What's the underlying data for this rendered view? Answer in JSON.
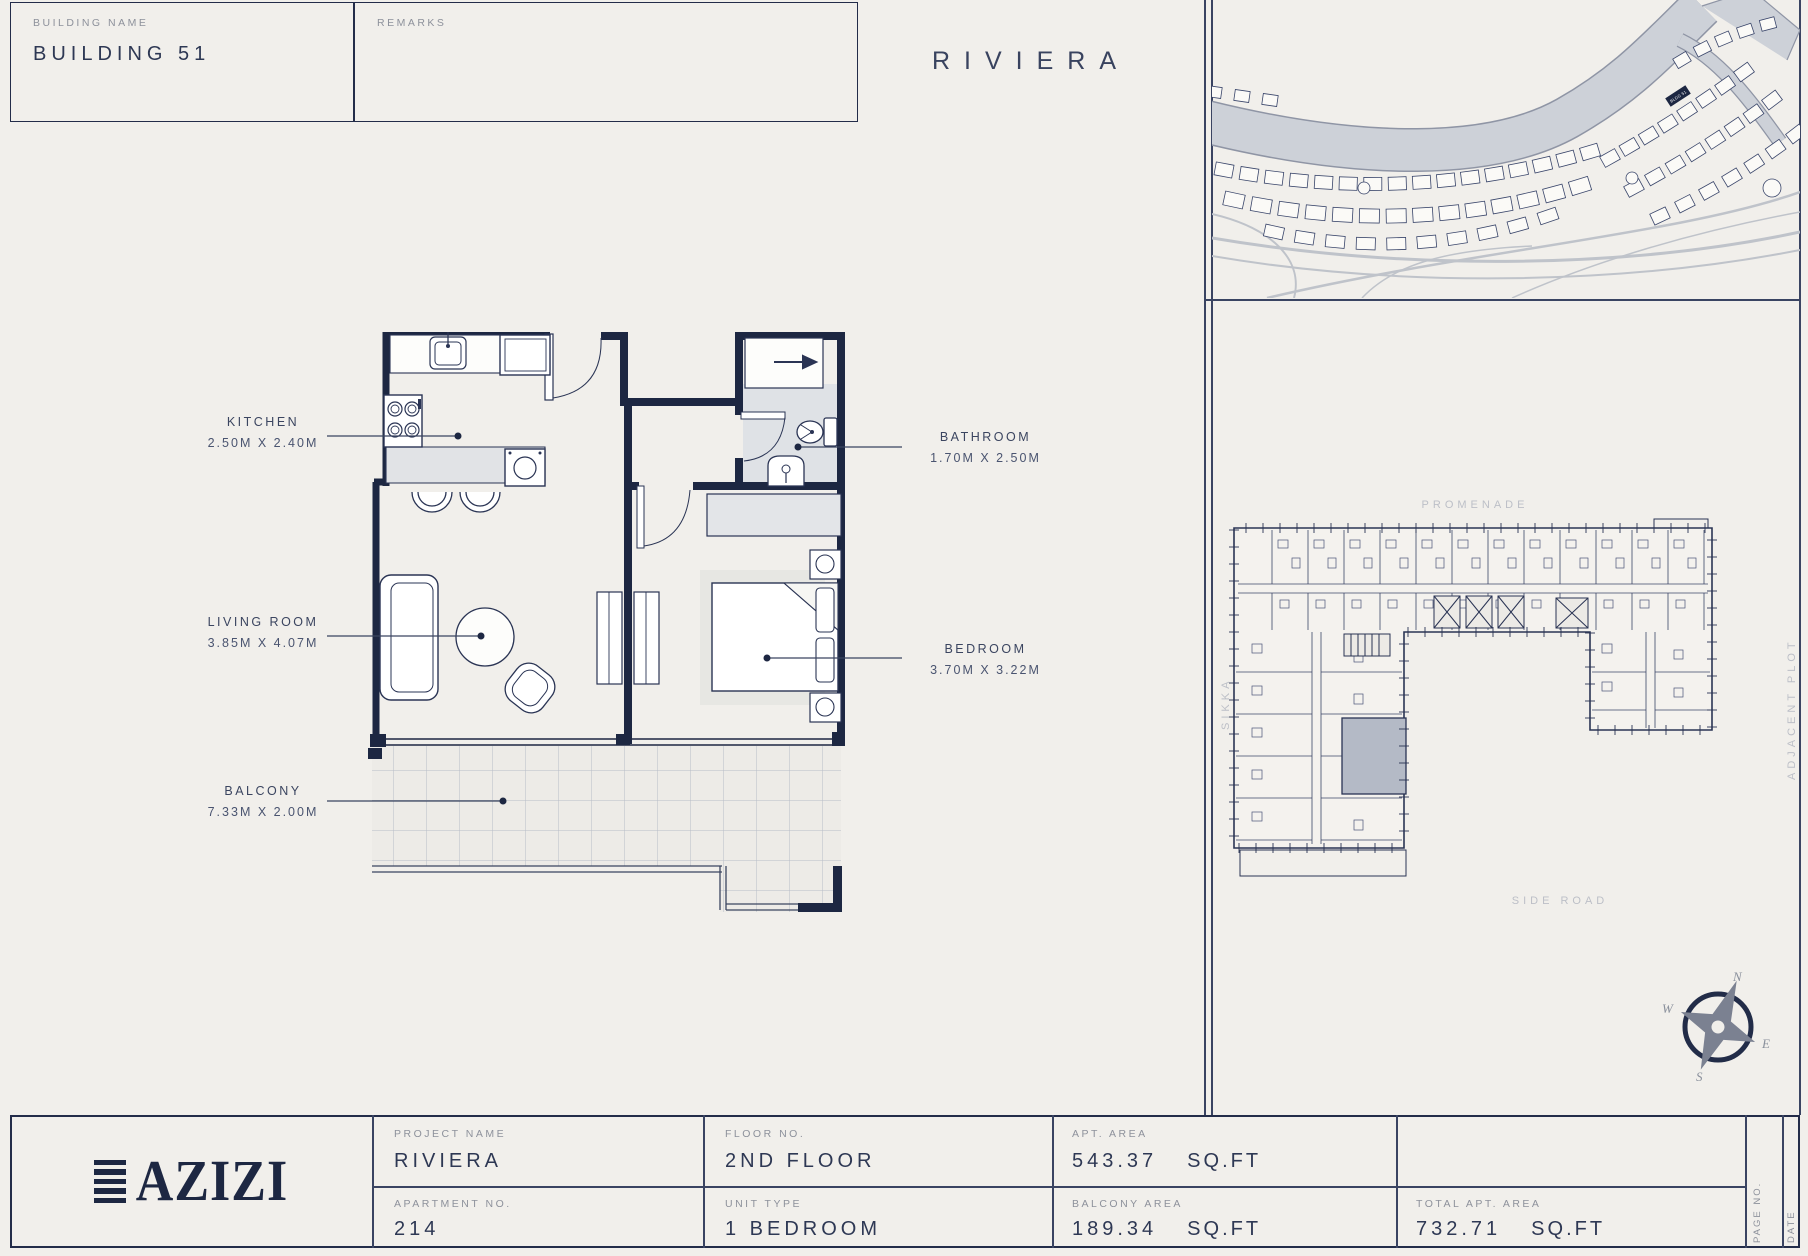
{
  "header": {
    "building_name_label": "BUILDING NAME",
    "building_name": "BUILDING 51",
    "remarks_label": "REMARKS",
    "project_title": "RIVIERA"
  },
  "floor_plan": {
    "rooms": [
      {
        "name": "KITCHEN",
        "dims": "2.50M X 2.40M"
      },
      {
        "name": "LIVING ROOM",
        "dims": "3.85M X 4.07M"
      },
      {
        "name": "BALCONY",
        "dims": "7.33M X 2.00M"
      },
      {
        "name": "BATHROOM",
        "dims": "1.70M X 2.50M"
      },
      {
        "name": "BEDROOM",
        "dims": "3.70M X 3.22M"
      }
    ]
  },
  "key_plan": {
    "promenade_label": "PROMENADE",
    "side_road_label": "SIDE ROAD",
    "sikka_label": "SIKKA",
    "adjacent_plot_label": "ADJACENT PLOT"
  },
  "site_map": {
    "highlighted_building": "BLDG 51"
  },
  "compass": {
    "north": "N",
    "south": "S",
    "east": "E",
    "west": "W"
  },
  "title_block": {
    "logo_text": "AZIZI",
    "columns": [
      {
        "top": {
          "label": "PROJECT NAME",
          "value": "RIVIERA"
        },
        "bottom": {
          "label": "APARTMENT NO.",
          "value": "214"
        }
      },
      {
        "top": {
          "label": "FLOOR NO.",
          "value": "2ND FLOOR"
        },
        "bottom": {
          "label": "UNIT TYPE",
          "value": "1 BEDROOM"
        }
      },
      {
        "top": {
          "label": "APT. AREA",
          "value": "543.37",
          "unit": "SQ.FT"
        },
        "bottom": {
          "label": "BALCONY AREA",
          "value": "189.34",
          "unit": "SQ.FT"
        }
      },
      {
        "top": {
          "label": "",
          "value": ""
        },
        "bottom": {
          "label": "TOTAL APT. AREA",
          "value": "732.71",
          "unit": "SQ.FT"
        }
      }
    ],
    "page_no_label": "PAGE NO.",
    "date_label": "DATE"
  },
  "colors": {
    "background": "#f1efeb",
    "ink_navy": "#1d2742",
    "line_navy": "#232c49",
    "label_gray": "#8d919b",
    "road_gray": "#cdd1d8",
    "counter_gray": "#e1e3e6",
    "highlight_unit_gray": "#b4bac6"
  }
}
